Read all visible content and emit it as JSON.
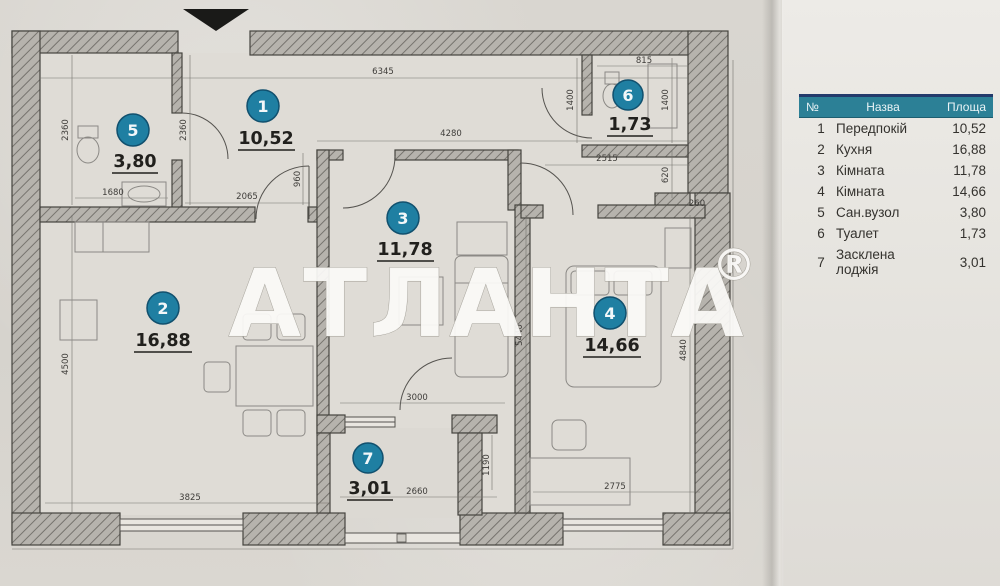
{
  "watermark": {
    "text": "АТЛАНТА",
    "reg": "®"
  },
  "colors": {
    "circle_fill": "#1f7fa2",
    "circle_stroke": "#11506e",
    "legend_header_bg": "#2c8096",
    "legend_header_top": "#233a6b",
    "wall_hatch": "#76736e",
    "arrow": "#1a1a18"
  },
  "plan": {
    "rooms": [
      {
        "num": "1",
        "area": "10,52"
      },
      {
        "num": "2",
        "area": "16,88"
      },
      {
        "num": "3",
        "area": "11,78"
      },
      {
        "num": "4",
        "area": "14,66"
      },
      {
        "num": "5",
        "area": "3,80"
      },
      {
        "num": "6",
        "area": "1,73"
      },
      {
        "num": "7",
        "area": "3,01"
      }
    ],
    "dims": {
      "top": "6345",
      "corridor": "4280",
      "r6_top": "815",
      "r6_left": "1400",
      "r6_right": "1400",
      "r6_under": "2515",
      "step_h": "620",
      "step_w": "260",
      "r5_left": "2360",
      "r5_right": "2360",
      "r5_width": "1680",
      "r1_opening": "2065",
      "r1_door": "960",
      "r2_height": "4500",
      "r2_width": "3825",
      "r3_balcony": "3000",
      "r7_width": "2660",
      "r7_height": "1190",
      "r4_left": "5440",
      "r4_right": "4840",
      "r4_width": "2775"
    }
  },
  "legend": {
    "header": {
      "num": "№",
      "name": "Назва",
      "area": "Площа"
    },
    "rows": [
      {
        "num": "1",
        "name": "Передпокій",
        "area": "10,52"
      },
      {
        "num": "2",
        "name": "Кухня",
        "area": "16,88"
      },
      {
        "num": "3",
        "name": "Кімната",
        "area": "11,78"
      },
      {
        "num": "4",
        "name": "Кімната",
        "area": "14,66"
      },
      {
        "num": "5",
        "name": "Сан.вузол",
        "area": "3,80"
      },
      {
        "num": "6",
        "name": "Туалет",
        "area": "1,73"
      },
      {
        "num": "7",
        "name": "Засклена лоджія",
        "area": "3,01"
      }
    ]
  }
}
